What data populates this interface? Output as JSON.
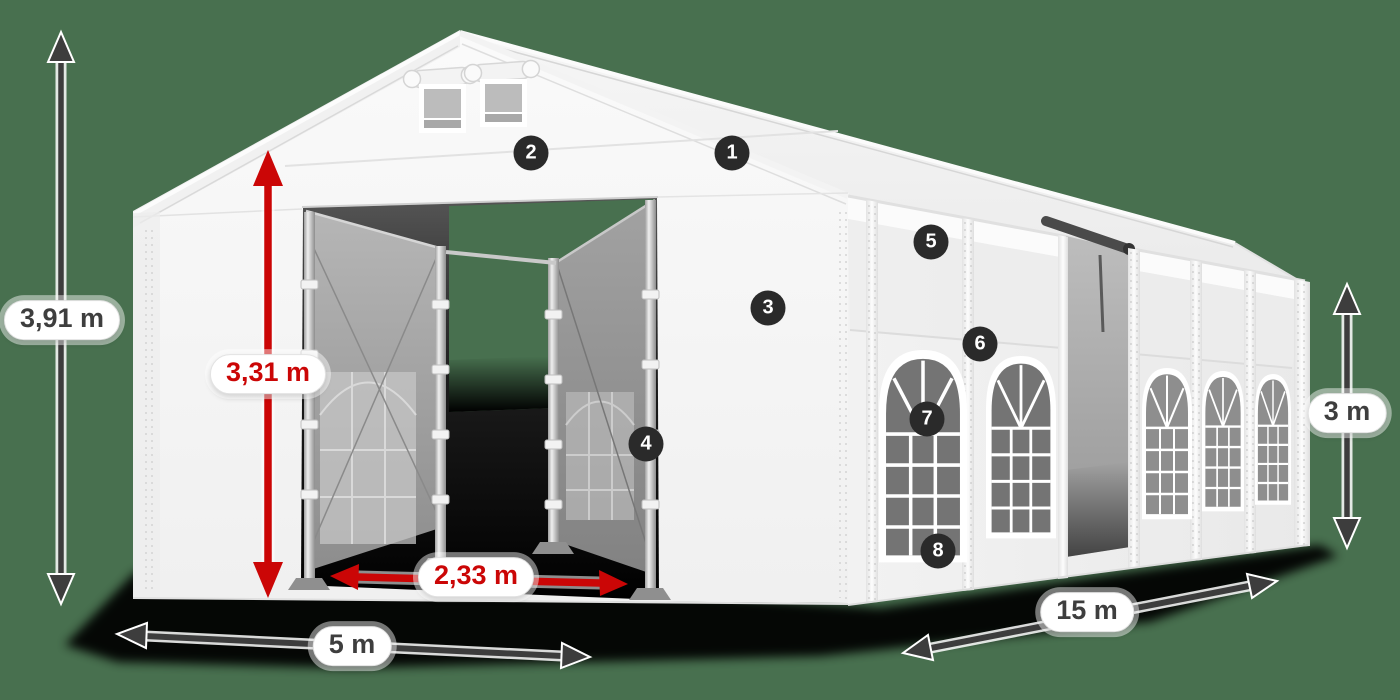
{
  "diagram": {
    "title": "Tent dimensions diagram",
    "background_color": "#48704F",
    "dimensions": [
      {
        "id": "total-height",
        "label": "3,91 m",
        "style": "dark",
        "orientation": "vertical"
      },
      {
        "id": "entrance-height",
        "label": "3,31 m",
        "style": "red",
        "orientation": "vertical"
      },
      {
        "id": "entrance-width",
        "label": "2,33 m",
        "style": "red",
        "orientation": "horizontal"
      },
      {
        "id": "front-width",
        "label": "5 m",
        "style": "dark",
        "orientation": "horizontal"
      },
      {
        "id": "side-length",
        "label": "15 m",
        "style": "dark",
        "orientation": "diagonal"
      },
      {
        "id": "side-height",
        "label": "3 m",
        "style": "dark",
        "orientation": "vertical"
      }
    ],
    "callouts": [
      {
        "number": "1"
      },
      {
        "number": "2"
      },
      {
        "number": "3"
      },
      {
        "number": "4"
      },
      {
        "number": "5"
      },
      {
        "number": "6"
      },
      {
        "number": "7"
      },
      {
        "number": "8"
      }
    ],
    "colors": {
      "arrow_dark": "#3d3d3d",
      "arrow_red": "#cb0606",
      "badge_background": "#2a2a2a",
      "badge_text": "#ffffff",
      "label_background": "#ffffff",
      "label_text_dark": "#3e3e3e",
      "label_text_red": "#cb0606"
    }
  }
}
